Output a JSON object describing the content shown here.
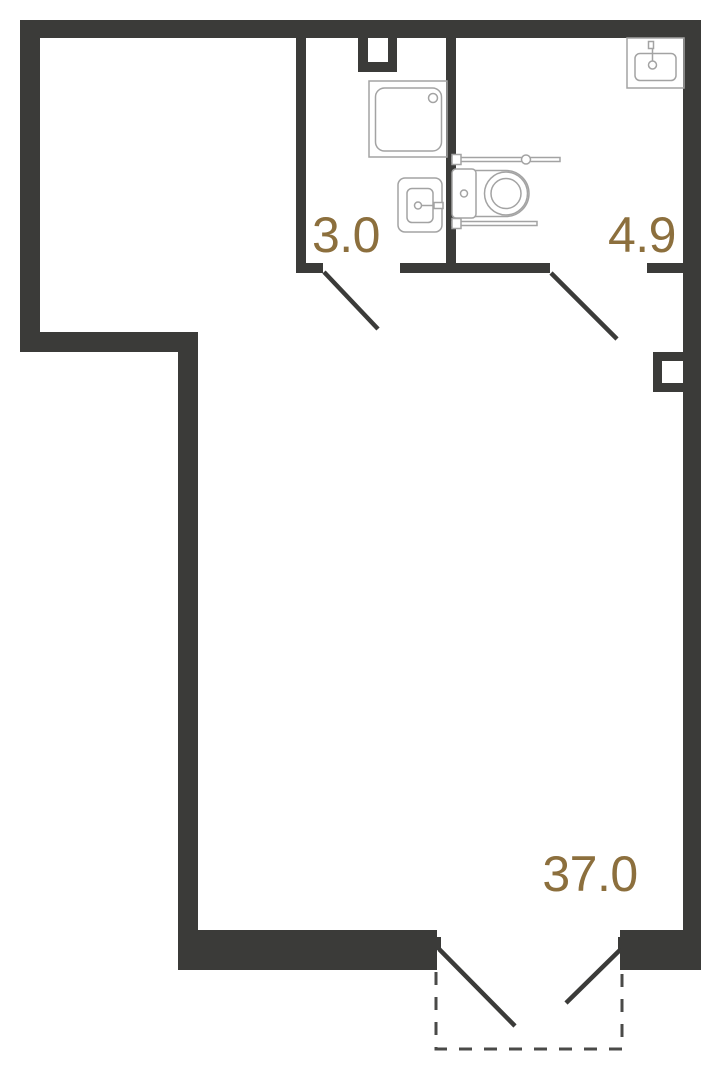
{
  "plan": {
    "colors": {
      "wall": "#3b3b39",
      "fixture_outline": "#a3a3a3",
      "area_label": "#8c6f3d",
      "door_dash": "#4a4a48",
      "background": "#ffffff"
    },
    "rooms": [
      {
        "name": "bathroom",
        "area": "3.0"
      },
      {
        "name": "wc",
        "area": "4.9"
      },
      {
        "name": "main-room",
        "area": "37.0"
      }
    ]
  }
}
